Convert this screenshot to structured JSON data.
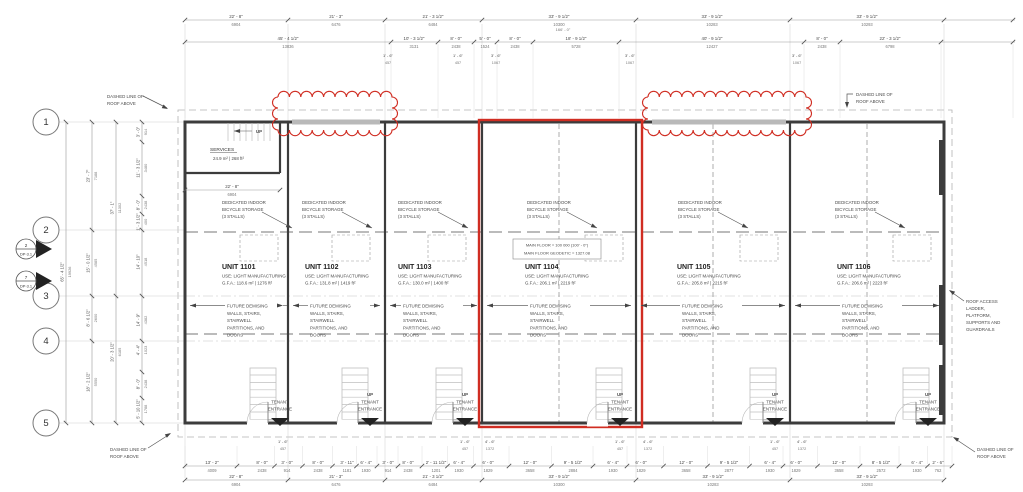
{
  "colors": {
    "red": "#d02d22",
    "wall": "#3c3c3c",
    "line": "#999999",
    "light": "#c9c9c9",
    "dim_text": "#4a4a4a",
    "mm_text": "#777777",
    "black": "#222222"
  },
  "units": [
    {
      "name": "UNIT 1101",
      "use": "USE: LIGHT MANUFACTURING",
      "gfa": "G.F.A.: 118.6 m² | 1276 ft²",
      "x": 222,
      "arrow": [
        190,
        283
      ],
      "cx": 280,
      "up": false,
      "stair": 250,
      "bike": 240,
      "bike_x": 222
    },
    {
      "name": "UNIT 1102",
      "use": "USE: LIGHT MANUFACTURING",
      "gfa": "G.F.A.: 131.8 m² | 1419 ft²",
      "x": 305,
      "arrow": [
        293,
        380
      ],
      "cx": 370,
      "up": true,
      "stair": 342,
      "bike": 332,
      "bike_x": 302
    },
    {
      "name": "UNIT 1103",
      "use": "USE: LIGHT MANUFACTURING",
      "gfa": "G.F.A.: 130.0 m² | 1400 ft²",
      "x": 398,
      "arrow": [
        390,
        477
      ],
      "cx": 465,
      "up": true,
      "stair": 436,
      "bike": 428,
      "bike_x": 398
    },
    {
      "name": "UNIT 1104",
      "use": "USE: LIGHT MANUFACTURING",
      "gfa": "G.F.A.: 206.1 m² | 2219 ft²",
      "x": 525,
      "arrow": [
        487,
        631
      ],
      "cx": 620,
      "up": true,
      "stair": 596,
      "bike": 585,
      "bike_x": 527,
      "highlighted": true
    },
    {
      "name": "UNIT 1105",
      "use": "USE: LIGHT MANUFACTURING",
      "gfa": "G.F.A.: 205.8 m² | 2215 ft²",
      "x": 677,
      "arrow": [
        641,
        785
      ],
      "cx": 775,
      "up": true,
      "stair": 750,
      "bike": 740,
      "bike_x": 678
    },
    {
      "name": "UNIT 1106",
      "use": "USE: LIGHT MANUFACTURING",
      "gfa": "G.F.A.: 206.6 m² | 2223 ft²",
      "x": 837,
      "arrow": [
        795,
        939
      ],
      "cx": 928,
      "up": true,
      "stair": 903,
      "bike": 893,
      "bike_x": 835
    }
  ],
  "labels": {
    "bike": [
      "DEDICATED INDOOR",
      "BICYCLE STORAGE",
      "(3 STALLS)"
    ],
    "future": [
      "FUTURE DEMISING",
      "WALLS, STAIRS,",
      "STAIRWELL",
      "PARTITIONS, AND",
      "DOORS"
    ],
    "tenant": [
      "TENANT",
      "ENTRANCE"
    ],
    "up": "UP",
    "services": "SERVICES",
    "services_area": "24.9 m² | 268 ft²",
    "main_floor": [
      "MAIN FLOOR = 100 000 (100' - 0\")",
      "MAIN FLOOR GEODETIC = 1327.08"
    ],
    "roof_note": [
      "DASHED LINE OF",
      "ROOF ABOVE"
    ],
    "roof_access": [
      "ROOF ACCESS",
      "LADDER,",
      "PLATFORM,",
      "SUPPORTS AND",
      "GUARDRAILS"
    ]
  },
  "roof_notes": [
    {
      "x": 107,
      "y": 98,
      "dir": "tl"
    },
    {
      "x": 856,
      "y": 96,
      "dir": "tr"
    },
    {
      "x": 110,
      "y": 451,
      "dir": "bl"
    },
    {
      "x": 977,
      "y": 451,
      "dir": "br"
    }
  ],
  "grid_bubbles": [
    {
      "label": "1",
      "y": 122
    },
    {
      "label": "2",
      "y": 230
    },
    {
      "label": "3",
      "y": 296
    },
    {
      "label": "4",
      "y": 341
    },
    {
      "label": "5",
      "y": 423
    }
  ],
  "section_markers": [
    {
      "num": "2",
      "sheet": "DP-3.1",
      "y": 249
    },
    {
      "num": "7",
      "sheet": "DP-3.1",
      "y": 281
    }
  ],
  "revision_clouds": [
    {
      "x": 278,
      "y": 97,
      "w": 114,
      "h": 33
    },
    {
      "x": 648,
      "y": 97,
      "w": 158,
      "h": 33
    }
  ],
  "dims": {
    "top1": {
      "y": 20,
      "x1": 185,
      "x2": 1015,
      "ticks": [
        185,
        288,
        385,
        482,
        636,
        790,
        944,
        1013
      ],
      "items": [
        {
          "x": 236,
          "ft": "22' - 8\"",
          "mm": "6904"
        },
        {
          "x": 336,
          "ft": "21' - 3\"",
          "mm": "6476"
        },
        {
          "x": 433,
          "ft": "21' - 3 1/2\"",
          "mm": "6484"
        },
        {
          "x": 559,
          "ft": "33' - 9 1/2\"",
          "mm": "10300"
        },
        {
          "x": 712,
          "ft": "33' - 9 1/2\"",
          "mm": "10283"
        },
        {
          "x": 867,
          "ft": "33' - 9 1/2\"",
          "mm": "10293"
        }
      ],
      "overall": {
        "x": 563,
        "y": 31,
        "t": "166' - 0\""
      }
    },
    "top2": {
      "y": 42,
      "x1": 185,
      "x2": 1015,
      "ticks": [
        185,
        391,
        438,
        474,
        497,
        533,
        619,
        804,
        840,
        941,
        1013
      ],
      "items": [
        {
          "x": 288,
          "ft": "45' - 4 1/2\"",
          "mm": "13836"
        },
        {
          "x": 414,
          "ft": "10' - 3 1/2\"",
          "mm": "3131"
        },
        {
          "x": 456,
          "ft": "8' - 0\"",
          "mm": "2438"
        },
        {
          "x": 485,
          "ft": "5' - 0\"",
          "mm": "1524"
        },
        {
          "x": 515,
          "ft": "8' - 0\"",
          "mm": "2438"
        },
        {
          "x": 576,
          "ft": "18' - 9 1/2\"",
          "mm": "5728"
        },
        {
          "x": 712,
          "ft": "40' - 9 1/2\"",
          "mm": "12427"
        },
        {
          "x": 822,
          "ft": "8' - 0\"",
          "mm": "2438"
        },
        {
          "x": 890,
          "ft": "22' - 3 1/2\"",
          "mm": "6798"
        }
      ]
    },
    "top_small": {
      "y_ft": 57,
      "y_mm": 64,
      "items": [
        {
          "x": 388,
          "ft": "1' - 6\"",
          "mm": "457"
        },
        {
          "x": 458,
          "ft": "1' - 6\"",
          "mm": "457"
        },
        {
          "x": 496,
          "ft": "3' - 6\"",
          "mm": "1067"
        },
        {
          "x": 630,
          "ft": "3' - 6\"",
          "mm": "1067"
        },
        {
          "x": 797,
          "ft": "3' - 6\"",
          "mm": "1067"
        }
      ]
    },
    "bottom_small": {
      "y_ft": 443,
      "y_mm": 450,
      "items": [
        {
          "x": 283,
          "ft": "1' - 6\"",
          "mm": "457"
        },
        {
          "x": 465,
          "ft": "1' - 6\"",
          "mm": "457"
        },
        {
          "x": 490,
          "ft": "4' - 6\"",
          "mm": "1372"
        },
        {
          "x": 620,
          "ft": "1' - 6\"",
          "mm": "457"
        },
        {
          "x": 648,
          "ft": "4' - 6\"",
          "mm": "1372"
        },
        {
          "x": 775,
          "ft": "1' - 6\"",
          "mm": "457"
        },
        {
          "x": 802,
          "ft": "4' - 6\"",
          "mm": "1372"
        }
      ]
    },
    "bottomA": {
      "y": 466,
      "x1": 185,
      "x2": 952,
      "items": [
        {
          "x": 212,
          "ft": "13' - 2\"",
          "mm": "4009"
        },
        {
          "x": 262,
          "ft": "8' - 0\"",
          "mm": "2438"
        },
        {
          "x": 287,
          "ft": "3' - 0\"",
          "mm": "914"
        },
        {
          "x": 318,
          "ft": "8' - 0\"",
          "mm": "2438"
        },
        {
          "x": 347,
          "ft": "3' - 11\"",
          "mm": "1181"
        },
        {
          "x": 366,
          "ft": "6' - 4\"",
          "mm": "1930"
        },
        {
          "x": 388,
          "ft": "3' - 0\"",
          "mm": "914"
        },
        {
          "x": 408,
          "ft": "8' - 0\"",
          "mm": "2438"
        },
        {
          "x": 436,
          "ft": "2' - 11 1/2\"",
          "mm": "1201"
        },
        {
          "x": 459,
          "ft": "6' - 4\"",
          "mm": "1930"
        },
        {
          "x": 488,
          "ft": "6' - 0\"",
          "mm": "1829"
        },
        {
          "x": 530,
          "ft": "12' - 0\"",
          "mm": "3658"
        },
        {
          "x": 573,
          "ft": "9' - 5 1/2\"",
          "mm": "2884"
        },
        {
          "x": 613,
          "ft": "6' - 4\"",
          "mm": "1930"
        },
        {
          "x": 641,
          "ft": "6' - 0\"",
          "mm": "1829"
        },
        {
          "x": 686,
          "ft": "12' - 0\"",
          "mm": "3658"
        },
        {
          "x": 729,
          "ft": "9' - 5 1/2\"",
          "mm": "2877"
        },
        {
          "x": 770,
          "ft": "6' - 4\"",
          "mm": "1930"
        },
        {
          "x": 796,
          "ft": "6' - 0\"",
          "mm": "1829"
        },
        {
          "x": 839,
          "ft": "12' - 0\"",
          "mm": "3658"
        },
        {
          "x": 881,
          "ft": "8' - 5 1/2\"",
          "mm": "2572"
        },
        {
          "x": 917,
          "ft": "6' - 4\"",
          "mm": "1930"
        },
        {
          "x": 938,
          "ft": "2' - 6\"",
          "mm": "762"
        }
      ]
    },
    "bottomB": {
      "y": 480,
      "x1": 185,
      "x2": 944,
      "ticks": [
        185,
        288,
        385,
        482,
        636,
        790,
        944
      ],
      "items": [
        {
          "x": 236,
          "ft": "22' - 8\"",
          "mm": "6904"
        },
        {
          "x": 336,
          "ft": "21' - 3\"",
          "mm": "6476"
        },
        {
          "x": 433,
          "ft": "21' - 3 1/2\"",
          "mm": "6484"
        },
        {
          "x": 559,
          "ft": "33' - 9 1/2\"",
          "mm": "10300"
        },
        {
          "x": 713,
          "ft": "33' - 9 1/2\"",
          "mm": "10283"
        },
        {
          "x": 867,
          "ft": "33' - 9 1/2\"",
          "mm": "10293"
        }
      ]
    },
    "left": [
      {
        "x": 66,
        "ticks": [
          122,
          423
        ],
        "items": [
          {
            "y": 272,
            "ft": "65' - 4 1/2\"",
            "mm": "19926"
          }
        ]
      },
      {
        "x": 92,
        "ticks": [
          122,
          230,
          296,
          341,
          423
        ],
        "items": [
          {
            "y": 176,
            "ft": "23' - 7\"",
            "mm": "7188"
          },
          {
            "y": 263,
            "ft": "15' - 0 1/2\"",
            "mm": "4585"
          },
          {
            "y": 318,
            "ft": "8' - 6 1/2\"",
            "mm": "2600"
          },
          {
            "y": 382,
            "ft": "18' - 2 1/2\"",
            "mm": "5550"
          }
        ]
      },
      {
        "x": 116,
        "ticks": [
          122,
          296,
          423
        ],
        "items": [
          {
            "y": 208,
            "ft": "37' - 1\"",
            "mm": "11302"
          },
          {
            "y": 352,
            "ft": "20' - 3 1/2\"",
            "mm": "6185"
          }
        ]
      },
      {
        "x": 142,
        "ticks": [
          122,
          142,
          196,
          214,
          230,
          296,
          341,
          372,
          398,
          423
        ],
        "items": [
          {
            "y": 132,
            "ft": "3' - 0\"",
            "mm": "914"
          },
          {
            "y": 168,
            "ft": "11' - 3 1/2\"",
            "mm": "3480"
          },
          {
            "y": 205,
            "ft": "8' - 0\"",
            "mm": "2438"
          },
          {
            "y": 222,
            "ft": "1' - 3 1/2\"",
            "mm": "400"
          },
          {
            "y": 262,
            "ft": "14' - 10\"",
            "mm": "4518"
          },
          {
            "y": 320,
            "ft": "14' - 9\"",
            "mm": "4382"
          },
          {
            "y": 350,
            "ft": "4' - 4\"",
            "mm": "1023"
          },
          {
            "y": 384,
            "ft": "8' - 0\"",
            "mm": "2438"
          },
          {
            "y": 409,
            "ft": "5' - 10 1/2\"",
            "mm": "1788"
          }
        ]
      }
    ],
    "interior": [
      {
        "x": 232,
        "y": 190,
        "x1": 185,
        "x2": 280,
        "ft": "22' - 8\"",
        "mm": "6904"
      }
    ]
  }
}
